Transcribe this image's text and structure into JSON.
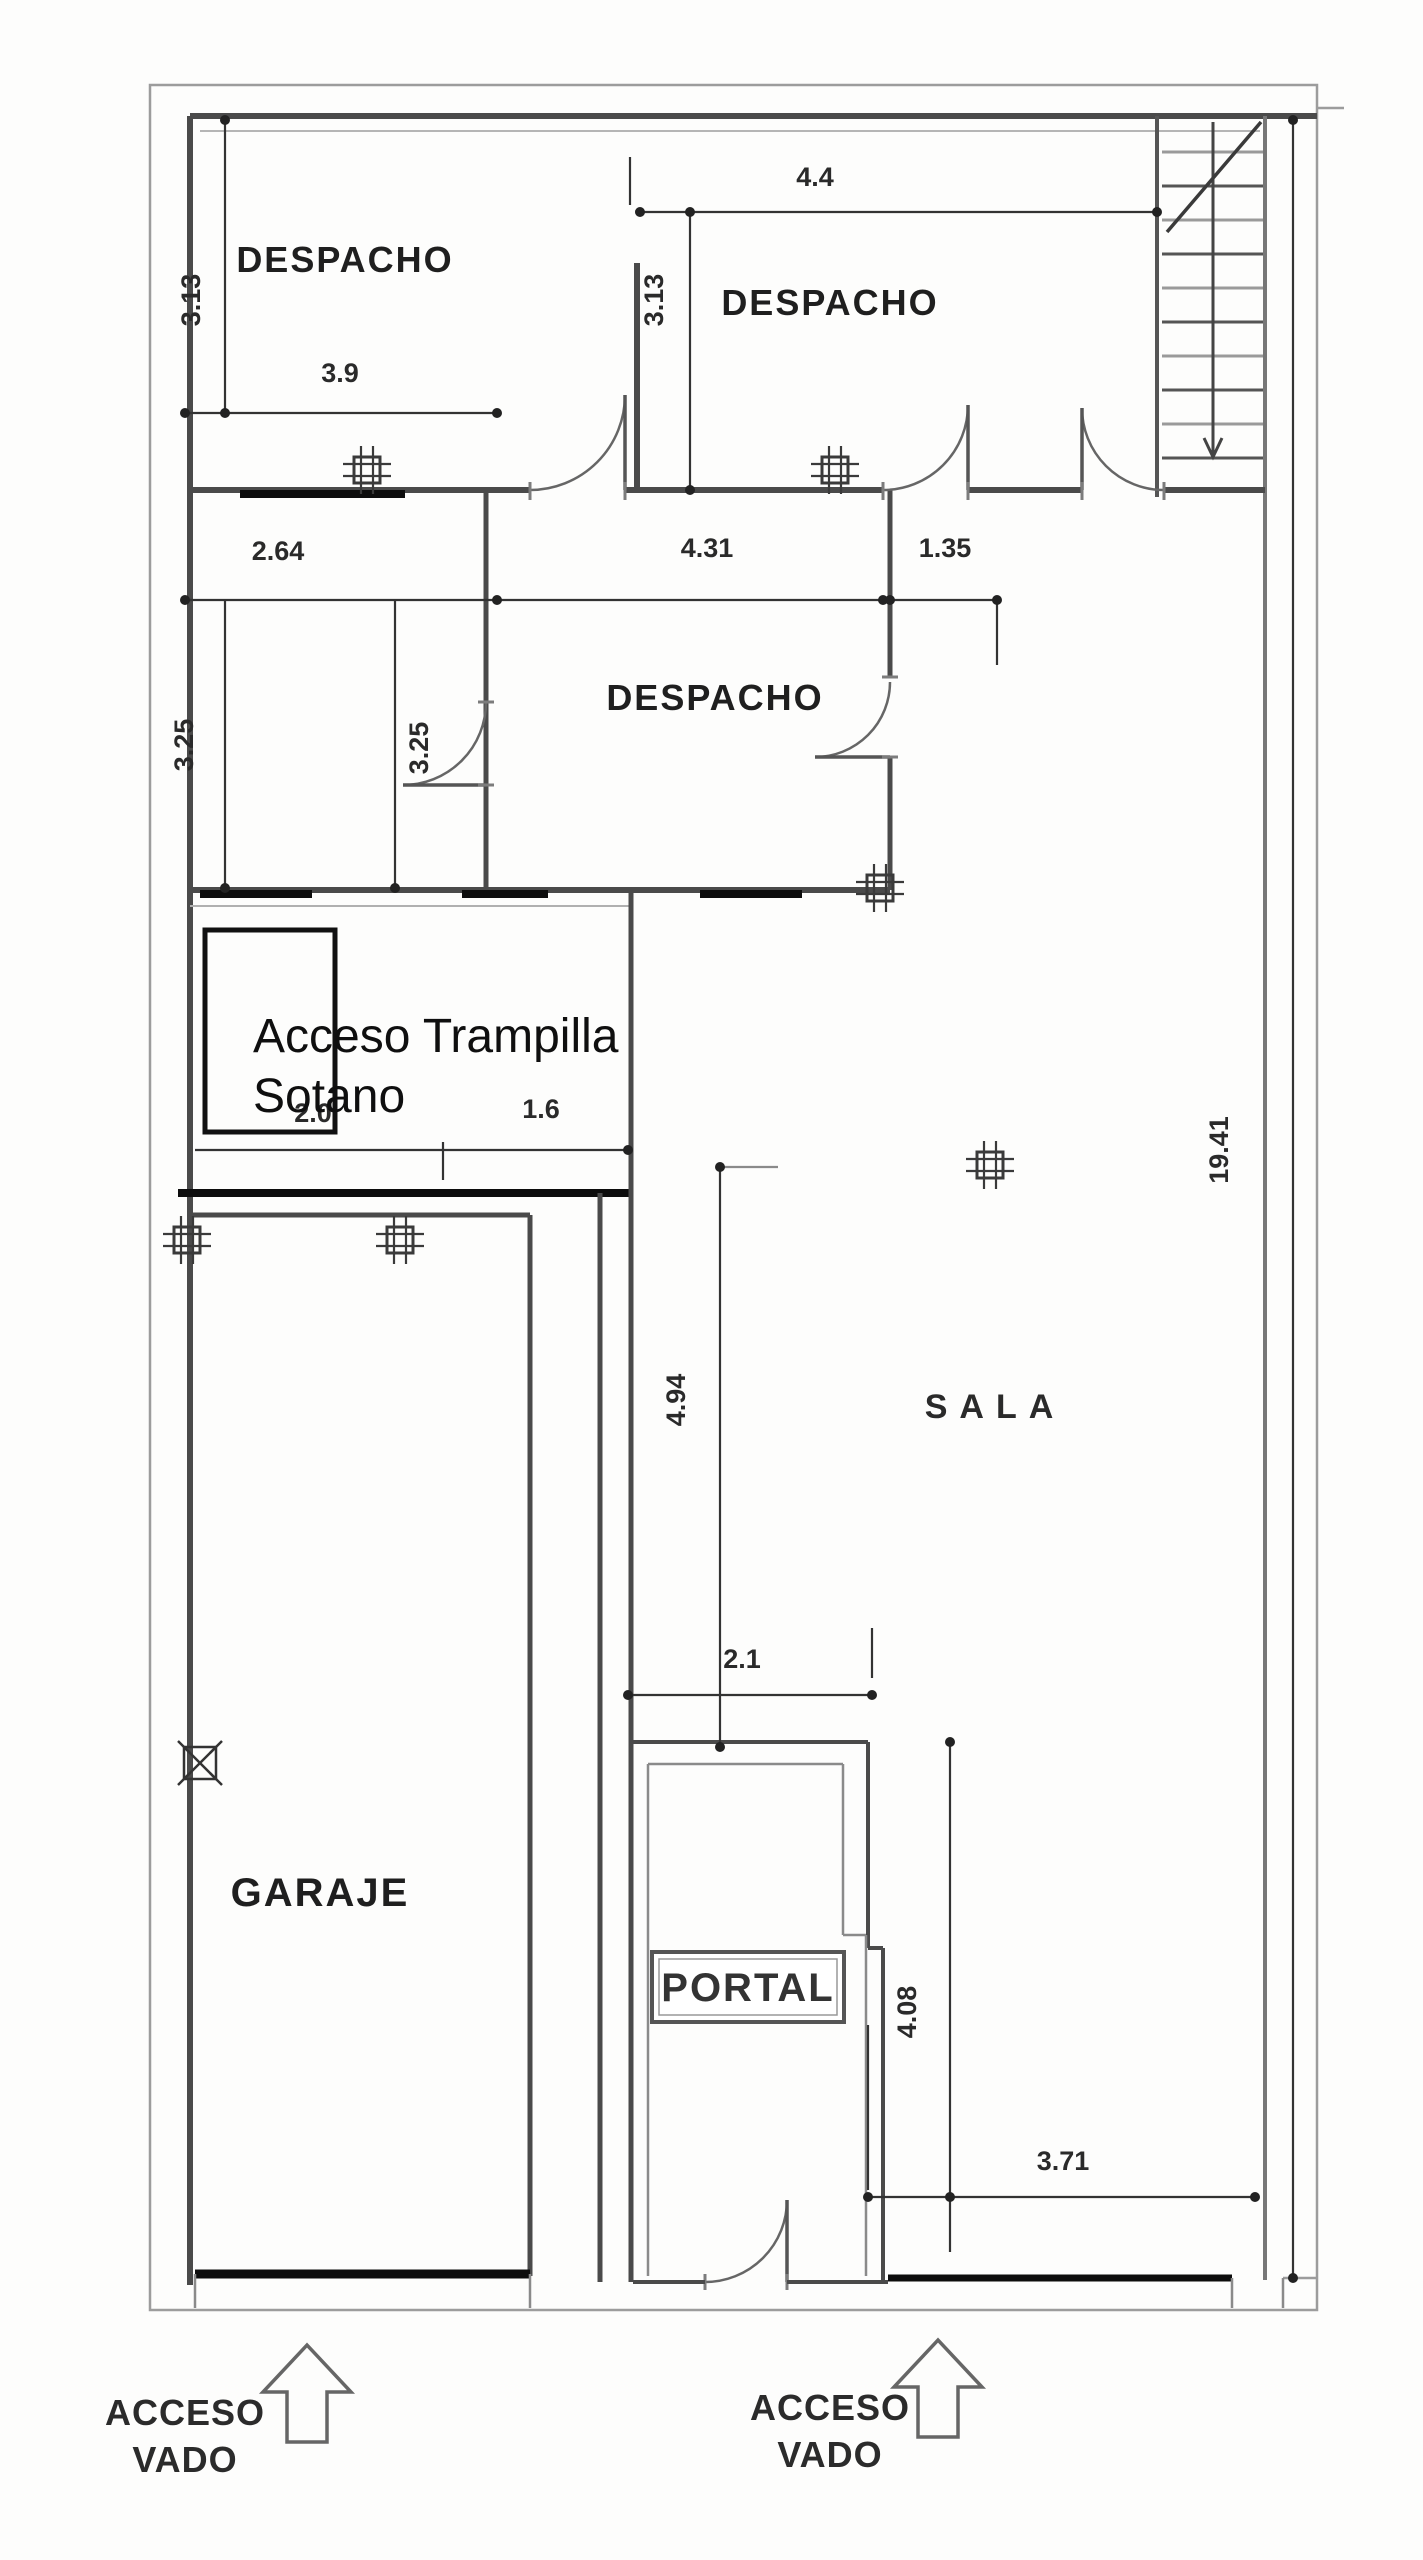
{
  "rooms": {
    "despacho_top_left": "DESPACHO",
    "despacho_top_right": "DESPACHO",
    "despacho_middle": "DESPACHO",
    "sala": "SALA",
    "garaje": "GARAJE",
    "portal": "PORTAL"
  },
  "annotations": {
    "trapdoor_line1": "Acceso Trampilla",
    "trapdoor_line2": "Sotano",
    "access_left_line1": "ACCESO",
    "access_left_line2": "VADO",
    "access_right_line1": "ACCESO",
    "access_right_line2": "VADO"
  },
  "dimensions": {
    "v313_left": "3.13",
    "h39": "3.9",
    "h44": "4.4",
    "v313_right": "3.13",
    "h264": "2.64",
    "h431": "4.31",
    "h135": "1.35",
    "v325_left": "3.25",
    "v325_right": "3.25",
    "h20": "2.0",
    "h16": "1.6",
    "v1941": "19.41",
    "v494": "4.94",
    "h21": "2.1",
    "v408": "4.08",
    "h371": "3.71"
  },
  "icons": {
    "stairs": "stairs-run-with-down-arrow",
    "columns": "structural-column-icon",
    "drain": "crossed-box-drain-icon",
    "arrows": "hollow-up-arrow-icon"
  },
  "colors": {
    "site_boundary": "#9c9c9c",
    "wall": "#4a4a4a",
    "wall_light": "#8a8a8a",
    "black_element": "#0d0d0d",
    "dim_line": "#333333",
    "background": "#fdfdfc"
  }
}
